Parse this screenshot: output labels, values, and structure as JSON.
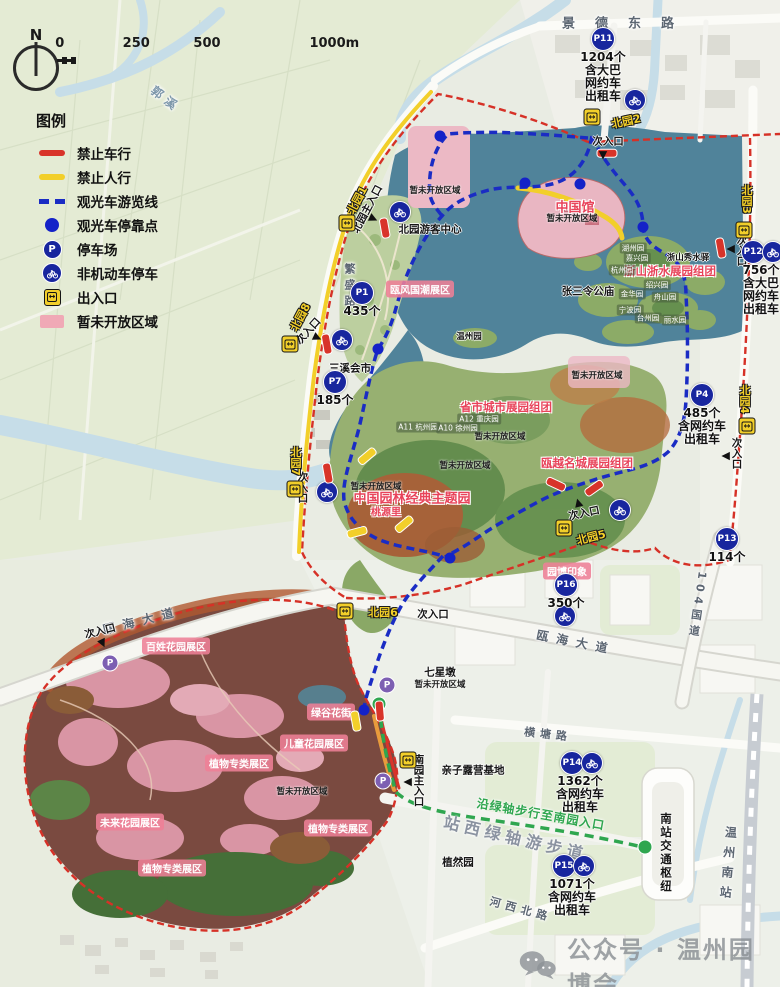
{
  "compass": {
    "label": "N"
  },
  "scalebar": {
    "ticks": [
      "0",
      "250",
      "500",
      "1000m"
    ]
  },
  "legend": {
    "title": "图例",
    "items": [
      {
        "swatch": "rline",
        "label": "禁止车行"
      },
      {
        "swatch": "yline",
        "label": "禁止人行"
      },
      {
        "swatch": "bdash",
        "label": "观光车游览线"
      },
      {
        "swatch": "bdot",
        "label": "观光车停靠点"
      },
      {
        "swatch": "mpk",
        "label": "停车场"
      },
      {
        "swatch": "mbike",
        "label": "非机动车停车"
      },
      {
        "swatch": "mgate",
        "label": "出入口"
      },
      {
        "swatch": "parea",
        "label": "暂未开放区域"
      }
    ]
  },
  "watermark": {
    "text": "公众号 · 温州园博会",
    "icon": "wechat-icon"
  },
  "colors": {
    "boundary_red": "#d63127",
    "no_vehicle_red": "#d8342a",
    "no_pedestrian_yellow": "#f2cf2a",
    "tour_route_blue": "#1a2cc4",
    "tour_stop_blue": "#1422c8",
    "parking_navy": "#18269e",
    "small_parking_purple": "#7d5fb2",
    "gate_yellow": "#f2cf2a",
    "closed_area_pink": "#ecb9c5",
    "greenway_green": "#2fa64f",
    "lake_teal": "#50839a"
  },
  "map_labels": [
    {
      "t": "景德东路",
      "x": 628,
      "y": 22,
      "c": "road ls-xl",
      "n": "road-jingde-east"
    },
    {
      "t": "郭溪",
      "x": 166,
      "y": 99,
      "c": "road river",
      "r": 38,
      "n": "river-guoxi"
    },
    {
      "t": "繁盛路",
      "x": 349,
      "y": 287,
      "c": "road sm",
      "v": 1,
      "n": "road-fansheng"
    },
    {
      "t": "瓯海大道",
      "x": 142,
      "y": 620,
      "c": "road",
      "r": -14,
      "n": "road-ouhai-avenue-west"
    },
    {
      "t": "瓯海大道",
      "x": 576,
      "y": 642,
      "c": "road",
      "r": 11,
      "n": "road-ouhai-avenue-east"
    },
    {
      "t": "104国道",
      "x": 697,
      "y": 606,
      "c": "road sm",
      "v": 1,
      "r": 8,
      "n": "road-g104"
    },
    {
      "t": "横塘路",
      "x": 548,
      "y": 734,
      "c": "road sm",
      "r": 6,
      "n": "road-hengtang"
    },
    {
      "t": "河西北路",
      "x": 521,
      "y": 909,
      "c": "road sm",
      "r": 15,
      "n": "road-hexi-north"
    },
    {
      "t": "温州南站",
      "x": 728,
      "y": 866,
      "c": "road",
      "v": 1,
      "r": 5,
      "n": "wenzhou-south-station-label"
    },
    {
      "t": "南站交通枢纽",
      "x": 666,
      "y": 853,
      "c": "blk md",
      "v": 1,
      "n": "south-station-hub-label"
    },
    {
      "t": "站西绿轴游步道",
      "x": 516,
      "y": 837,
      "c": "gray-big",
      "r": 13,
      "n": "greenway-name-label"
    },
    {
      "t": "沿绿轴步行至南园入口",
      "x": 541,
      "y": 814,
      "c": "green-t",
      "r": 10,
      "n": "greenway-hint-label"
    },
    {
      "t": "次入口",
      "x": 608,
      "y": 141,
      "c": "blk entr"
    },
    {
      "t": "次入口",
      "x": 742,
      "y": 250,
      "c": "blk entr",
      "v": 1
    },
    {
      "t": "次入口",
      "x": 308,
      "y": 331,
      "c": "blk entr",
      "r": -48
    },
    {
      "t": "次入口",
      "x": 303,
      "y": 487,
      "c": "blk entr",
      "v": 1
    },
    {
      "t": "次入口",
      "x": 737,
      "y": 453,
      "c": "blk entr",
      "v": 1
    },
    {
      "t": "次入口",
      "x": 584,
      "y": 513,
      "c": "blk entr",
      "r": -12
    },
    {
      "t": "次入口",
      "x": 100,
      "y": 631,
      "c": "blk entr",
      "r": -14
    },
    {
      "t": "次入口",
      "x": 433,
      "y": 614,
      "c": "blk entr"
    },
    {
      "t": "北园主入口",
      "x": 367,
      "y": 209,
      "c": "blk entr",
      "r": -62,
      "n": "north-main-entrance-label"
    },
    {
      "t": "南园主入口",
      "x": 419,
      "y": 780,
      "c": "blk entr",
      "v": 1,
      "n": "south-main-entrance-label"
    },
    {
      "t": "北园1",
      "x": 357,
      "y": 200,
      "c": "gate-label",
      "r": -62
    },
    {
      "t": "北园2",
      "x": 626,
      "y": 121,
      "c": "gate-label",
      "r": -12
    },
    {
      "t": "北园3",
      "x": 746,
      "y": 199,
      "c": "gate-label",
      "v": 1
    },
    {
      "t": "北园8",
      "x": 300,
      "y": 317,
      "c": "gate-label",
      "r": -62
    },
    {
      "t": "北园4",
      "x": 744,
      "y": 399,
      "c": "gate-label",
      "v": 1
    },
    {
      "t": "北园5",
      "x": 591,
      "y": 537,
      "c": "gate-label",
      "r": -14
    },
    {
      "t": "北园6",
      "x": 383,
      "y": 612,
      "c": "gate-label"
    },
    {
      "t": "北园7",
      "x": 295,
      "y": 461,
      "c": "gate-label",
      "v": 1
    },
    {
      "t": "瓯风国潮展区",
      "x": 420,
      "y": 289,
      "c": "pink-label"
    },
    {
      "t": "百姓花园展区",
      "x": 176,
      "y": 646,
      "c": "pink-label"
    },
    {
      "t": "绿谷花街",
      "x": 331,
      "y": 712,
      "c": "pink-label"
    },
    {
      "t": "儿童花园展区",
      "x": 314,
      "y": 743,
      "c": "pink-label"
    },
    {
      "t": "植物专类展区",
      "x": 239,
      "y": 763,
      "c": "pink-label"
    },
    {
      "t": "未来花园展区",
      "x": 130,
      "y": 822,
      "c": "pink-label"
    },
    {
      "t": "植物专类展区",
      "x": 338,
      "y": 828,
      "c": "pink-label"
    },
    {
      "t": "植物专类展区",
      "x": 172,
      "y": 868,
      "c": "pink-label"
    },
    {
      "t": "园博印象",
      "x": 567,
      "y": 571,
      "c": "pink-label"
    },
    {
      "t": "中国馆",
      "x": 575,
      "y": 206,
      "c": "red-label big"
    },
    {
      "t": "浙山浙水展园组团",
      "x": 670,
      "y": 271,
      "c": "red-label"
    },
    {
      "t": "省市城市展园组团",
      "x": 506,
      "y": 407,
      "c": "red-label"
    },
    {
      "t": "瓯越名城展园组团",
      "x": 587,
      "y": 463,
      "c": "red-label"
    },
    {
      "t": "中国园林经典主题园",
      "x": 412,
      "y": 497,
      "c": "red-label big"
    },
    {
      "t": "桃源里",
      "x": 386,
      "y": 511,
      "c": "red-label sm"
    },
    {
      "t": "北园游客中心",
      "x": 430,
      "y": 229,
      "c": "blk"
    },
    {
      "t": "张三令公庙",
      "x": 588,
      "y": 291,
      "c": "blk"
    },
    {
      "t": "温州园",
      "x": 469,
      "y": 336,
      "c": "blk sm2"
    },
    {
      "t": "三溪会市",
      "x": 350,
      "y": 368,
      "c": "blk"
    },
    {
      "t": "浙山秀水驿",
      "x": 688,
      "y": 257,
      "c": "blk sm2"
    },
    {
      "t": "七星墩",
      "x": 440,
      "y": 672,
      "c": "blk"
    },
    {
      "t": "亲子露营基地",
      "x": 473,
      "y": 770,
      "c": "blk"
    },
    {
      "t": "植然园",
      "x": 458,
      "y": 862,
      "c": "blk"
    },
    {
      "t": "暂未开放区域",
      "x": 435,
      "y": 190,
      "c": "closed"
    },
    {
      "t": "暂未开放区域",
      "x": 572,
      "y": 218,
      "c": "closed"
    },
    {
      "t": "暂未开放区域",
      "x": 597,
      "y": 375,
      "c": "closed"
    },
    {
      "t": "暂未开放区域",
      "x": 500,
      "y": 436,
      "c": "closed"
    },
    {
      "t": "暂未开放区域",
      "x": 465,
      "y": 465,
      "c": "closed"
    },
    {
      "t": "暂未开放区域",
      "x": 376,
      "y": 486,
      "c": "closed"
    },
    {
      "t": "暂未开放区域",
      "x": 440,
      "y": 684,
      "c": "closed"
    },
    {
      "t": "暂未开放区域",
      "x": 302,
      "y": 791,
      "c": "closed"
    },
    {
      "t": "湖州园",
      "x": 633,
      "y": 248,
      "c": "tiny"
    },
    {
      "t": "嘉兴园",
      "x": 637,
      "y": 258,
      "c": "tiny"
    },
    {
      "t": "杭州园",
      "x": 622,
      "y": 270,
      "c": "tiny"
    },
    {
      "t": "绍兴园",
      "x": 657,
      "y": 285,
      "c": "tiny"
    },
    {
      "t": "金华园",
      "x": 632,
      "y": 294,
      "c": "tiny"
    },
    {
      "t": "舟山园",
      "x": 665,
      "y": 297,
      "c": "tiny"
    },
    {
      "t": "宁波园",
      "x": 630,
      "y": 310,
      "c": "tiny"
    },
    {
      "t": "台州园",
      "x": 648,
      "y": 318,
      "c": "tiny"
    },
    {
      "t": "丽水园",
      "x": 675,
      "y": 320,
      "c": "tiny"
    },
    {
      "t": "A11 杭州园",
      "x": 418,
      "y": 427,
      "c": "tiny"
    },
    {
      "t": "A10 徐州园",
      "x": 458,
      "y": 428,
      "c": "tiny"
    },
    {
      "t": "A12 重庆园",
      "x": 479,
      "y": 419,
      "c": "tiny"
    }
  ],
  "map_icons": [
    {
      "k": "gate",
      "x": 347,
      "y": 223
    },
    {
      "k": "gate",
      "x": 592,
      "y": 117
    },
    {
      "k": "gate",
      "x": 744,
      "y": 230
    },
    {
      "k": "gate",
      "x": 290,
      "y": 344
    },
    {
      "k": "gate",
      "x": 747,
      "y": 426
    },
    {
      "k": "gate",
      "x": 564,
      "y": 528
    },
    {
      "k": "gate",
      "x": 345,
      "y": 611
    },
    {
      "k": "gate",
      "x": 295,
      "y": 489
    },
    {
      "k": "gate",
      "x": 408,
      "y": 760
    },
    {
      "k": "bike",
      "x": 400,
      "y": 212
    },
    {
      "k": "bike",
      "x": 635,
      "y": 100
    },
    {
      "k": "bike",
      "x": 342,
      "y": 340
    },
    {
      "k": "bike",
      "x": 327,
      "y": 492
    },
    {
      "k": "bike",
      "x": 620,
      "y": 510
    },
    {
      "k": "bike",
      "x": 565,
      "y": 616
    },
    {
      "k": "stop",
      "x": 440,
      "y": 136
    },
    {
      "k": "stop",
      "x": 525,
      "y": 183
    },
    {
      "k": "stop",
      "x": 580,
      "y": 184
    },
    {
      "k": "stop",
      "x": 643,
      "y": 227
    },
    {
      "k": "stop",
      "x": 378,
      "y": 349
    },
    {
      "k": "stop",
      "x": 450,
      "y": 558
    },
    {
      "k": "stop",
      "x": 364,
      "y": 710
    },
    {
      "k": "gdot",
      "x": 379,
      "y": 704
    },
    {
      "k": "gdot",
      "x": 645,
      "y": 847
    },
    {
      "k": "rbar",
      "x": 607,
      "y": 153,
      "r": 0
    },
    {
      "k": "rbar",
      "x": 385,
      "y": 228,
      "r": 80
    },
    {
      "k": "rbar",
      "x": 327,
      "y": 344,
      "r": 80
    },
    {
      "k": "rbar",
      "x": 328,
      "y": 473,
      "r": 80
    },
    {
      "k": "rbar",
      "x": 721,
      "y": 248,
      "r": 80
    },
    {
      "k": "rbar",
      "x": 556,
      "y": 484,
      "r": 25
    },
    {
      "k": "rbar",
      "x": 594,
      "y": 488,
      "r": -35
    },
    {
      "k": "rbar",
      "x": 380,
      "y": 711,
      "r": 85
    },
    {
      "k": "ybar",
      "x": 367,
      "y": 456,
      "r": -40
    },
    {
      "k": "ybar",
      "x": 404,
      "y": 524,
      "r": -40
    },
    {
      "k": "ybar",
      "x": 357,
      "y": 532,
      "r": -15
    },
    {
      "k": "ybar",
      "x": 356,
      "y": 721,
      "r": 80
    },
    {
      "k": "arw",
      "x": 603,
      "y": 156,
      "r": 180
    },
    {
      "k": "arw",
      "x": 730,
      "y": 249,
      "r": -90
    },
    {
      "k": "arw",
      "x": 318,
      "y": 338,
      "r": 115
    },
    {
      "k": "arw",
      "x": 725,
      "y": 456,
      "r": -90
    },
    {
      "k": "arw",
      "x": 578,
      "y": 502,
      "r": -15
    },
    {
      "k": "arw",
      "x": 103,
      "y": 644,
      "r": 155
    },
    {
      "k": "arw",
      "x": 374,
      "y": 219,
      "r": 115
    },
    {
      "k": "arw",
      "x": 407,
      "y": 782,
      "r": -90
    },
    {
      "k": "pks",
      "x": 110,
      "y": 663
    },
    {
      "k": "pks",
      "x": 387,
      "y": 685
    },
    {
      "k": "pks",
      "x": 383,
      "y": 781
    }
  ],
  "parkings": [
    {
      "id": "P11",
      "x": 603,
      "y": 39,
      "lines": [
        "1204个",
        "含大巴",
        "网约车",
        "出租车"
      ]
    },
    {
      "id": "P12",
      "x": 753,
      "y": 252,
      "bike": true,
      "lines": [
        "756个",
        "含大巴",
        "网约车",
        "出租车"
      ]
    },
    {
      "id": "P1",
      "x": 362,
      "y": 293,
      "lines": [
        "435个"
      ]
    },
    {
      "id": "P7",
      "x": 335,
      "y": 382,
      "lines": [
        "185个"
      ]
    },
    {
      "id": "P4",
      "x": 702,
      "y": 395,
      "lines": [
        "485个",
        "含网约车",
        "出租车"
      ]
    },
    {
      "id": "P13",
      "x": 727,
      "y": 539,
      "lines": [
        "114个"
      ]
    },
    {
      "id": "P16",
      "x": 566,
      "y": 585,
      "lines": [
        "350个"
      ]
    },
    {
      "id": "P14",
      "x": 572,
      "y": 763,
      "bike": true,
      "lines": [
        "1362个",
        "含网约车",
        "出租车"
      ]
    },
    {
      "id": "P15",
      "x": 564,
      "y": 866,
      "bike": true,
      "lines": [
        "1071个",
        "含网约车",
        "出租车"
      ]
    }
  ]
}
